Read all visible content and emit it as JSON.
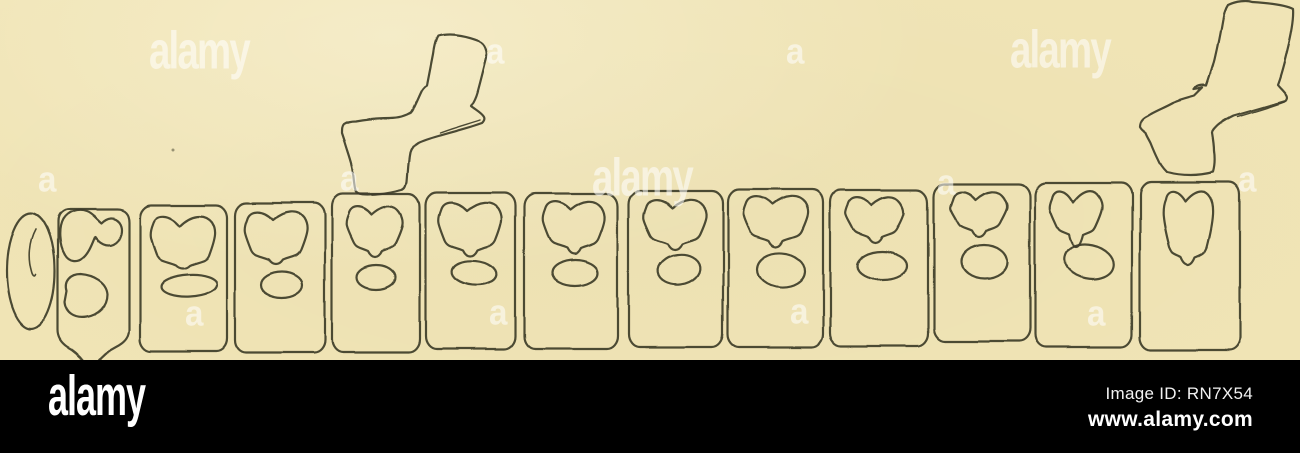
{
  "canvas": {
    "width": 1300,
    "height": 453,
    "paper_color": "#f1e5b6",
    "ink_color": "#3e3c29",
    "bar_color": "#000000",
    "watermark_color": "rgba(255,255,255,0.48)"
  },
  "footer": {
    "logo_text": "alamy",
    "image_id": "Image ID: RN7X54",
    "website": "www.alamy.com"
  },
  "watermarks": [
    {
      "text": "alamy",
      "kind": "wordmark",
      "x": 149,
      "y": 24
    },
    {
      "text": "a",
      "kind": "letter",
      "x": 486,
      "y": 33
    },
    {
      "text": "a",
      "kind": "letter",
      "x": 786,
      "y": 33
    },
    {
      "text": "alamy",
      "kind": "wordmark",
      "x": 1010,
      "y": 23
    },
    {
      "text": "a",
      "kind": "letter",
      "x": 38,
      "y": 161
    },
    {
      "text": "a",
      "kind": "letter",
      "x": 340,
      "y": 160
    },
    {
      "text": "alamy",
      "kind": "wordmark",
      "x": 592,
      "y": 151
    },
    {
      "text": "a",
      "kind": "letter",
      "x": 937,
      "y": 164
    },
    {
      "text": "a",
      "kind": "letter",
      "x": 1238,
      "y": 161
    },
    {
      "text": "a",
      "kind": "letter",
      "x": 185,
      "y": 295
    },
    {
      "text": "a",
      "kind": "letter",
      "x": 489,
      "y": 294
    },
    {
      "text": "a",
      "kind": "letter",
      "x": 790,
      "y": 293
    },
    {
      "text": "a",
      "kind": "letter",
      "x": 1087,
      "y": 295
    }
  ],
  "figure": {
    "description": "antique line drawing of a row of vertebral segments with two rib processes",
    "speck": {
      "cx": 173,
      "cy": 150,
      "r": 1.5
    },
    "lead_oval": {
      "cx": 31,
      "cy": 271,
      "rx": 24,
      "ry": 58,
      "slit": "M36,229 C29,242 28,258 32,272 C33,276 35,278 36,275"
    },
    "segment2": {
      "outline": "M70,209 C63,209 58,214 58,221 L58,330 C58,338 62,343 68,347 C74,350 80,356 84,361 C88,367 93,368 96,363 C101,356 108,350 116,346 C124,342 129,337 129,329 L129,222 C129,214 125,209 117,209 Z",
      "crown": "M65,255 C59,245 58,228 63,219 C68,211 78,208 86,211 C92,213 96,219 101,223 C107,217 114,216 119,222 C124,229 121,240 113,244 C106,247 99,243 95,237 C92,244 89,253 83,258 C77,263 69,262 65,255 Z",
      "blob": "M67,291 C64,281 71,274 81,274 C94,275 107,282 108,294 C108,306 99,315 87,317 C75,319 66,313 65,302 Z"
    },
    "segments": [
      {
        "rect": [
          140,
          205,
          87,
          146
        ],
        "crown": {
          "cx": 183,
          "top": 212,
          "w": 64,
          "h": 56,
          "stem": 4,
          "dip": 14
        },
        "oval": [
          189,
          286,
          28,
          11,
          -3
        ]
      },
      {
        "rect": [
          235,
          203,
          90,
          150
        ],
        "crown": {
          "cx": 276,
          "top": 208,
          "w": 62,
          "h": 54,
          "stem": 6,
          "dip": 12
        },
        "oval": [
          282,
          285,
          21,
          13,
          0
        ]
      },
      {
        "rect": [
          332,
          194,
          88,
          158
        ],
        "crown": {
          "cx": 375,
          "top": 203,
          "w": 56,
          "h": 50,
          "stem": 8,
          "dip": 12
        },
        "oval": [
          376,
          277,
          19,
          12,
          0
        ]
      },
      {
        "rect": [
          426,
          192,
          89,
          157
        ],
        "crown": {
          "cx": 470,
          "top": 198,
          "w": 62,
          "h": 54,
          "stem": 8,
          "dip": 12
        },
        "oval": [
          474,
          273,
          22,
          12,
          6
        ]
      },
      {
        "rect": [
          524,
          193,
          94,
          156
        ],
        "crown": {
          "cx": 574,
          "top": 197,
          "w": 62,
          "h": 53,
          "stem": 8,
          "dip": 12
        },
        "oval": [
          575,
          273,
          23,
          13,
          0
        ]
      },
      {
        "rect": [
          629,
          191,
          94,
          156
        ],
        "crown": {
          "cx": 675,
          "top": 196,
          "w": 62,
          "h": 50,
          "stem": 8,
          "dip": 12
        },
        "oval": [
          679,
          270,
          21,
          15,
          -8
        ]
      },
      {
        "rect": [
          728,
          190,
          95,
          157
        ],
        "crown": {
          "cx": 776,
          "top": 193,
          "w": 64,
          "h": 50,
          "stem": 8,
          "dip": 12
        },
        "oval": [
          781,
          270,
          24,
          17,
          4
        ]
      },
      {
        "rect": [
          830,
          190,
          98,
          156
        ],
        "crown": {
          "cx": 875,
          "top": 193,
          "w": 58,
          "h": 46,
          "stem": 8,
          "dip": 12
        },
        "oval": [
          882,
          266,
          25,
          14,
          0
        ]
      },
      {
        "rect": [
          934,
          184,
          96,
          157
        ],
        "crown": {
          "cx": 979,
          "top": 188,
          "w": 56,
          "h": 45,
          "stem": 8,
          "dip": 12
        },
        "oval": [
          984,
          262,
          23,
          17,
          0
        ]
      },
      {
        "rect": [
          1035,
          183,
          97,
          164
        ],
        "crown": {
          "cx": 1076,
          "top": 187,
          "w": 52,
          "h": 50,
          "stem": 16,
          "dip": 16
        },
        "oval": [
          1089,
          262,
          25,
          17,
          12
        ]
      },
      {
        "rect": [
          1140,
          182,
          100,
          168
        ],
        "crown": {
          "cx": 1188,
          "top": 187,
          "w": 50,
          "h": 72,
          "stem": 10,
          "dip": 14
        },
        "oval": null
      }
    ],
    "ribs": [
      {
        "path": "M438,37 C452,33 469,38 479,42 C484,44 487,51 486,58 C483,70 480,82 477,93 C475,100 473,103 471,106 C476,110 482,113 484,117 C485,119 484,121 482,123 C468,128 452,132 438,136 C431,138 424,140 418,143 C413,146 411,149 410,153 C408,163 408,172 407,182 C406,187 405,189 402,190 C391,193 379,195 368,195 C362,195 357,194 356,191 C354,182 354,172 352,165 C350,157 347,149 345,142 C344,139 343,136 342,133 C342,129 342,126 344,124 C347,122 352,121 356,121 C367,119 379,118 390,118 C398,118 406,116 412,112 C416,105 419,97 422,91 C424,88 425,87 427,86 C429,76 431,65 433,55 C434,48 436,40 438,37 Z",
        "flange": "M440,133 C453,128 468,124 480,120"
      },
      {
        "path": "M1228,5 C1236,1 1247,0 1252,2 C1268,3 1286,5 1293,9 C1294,21 1290,38 1287,50 C1284,62 1281,75 1277,85 C1280,89 1284,92 1286,96 C1287,98 1286,100 1285,101 C1268,106 1250,111 1233,116 C1227,119 1220,123 1217,126 C1214,129 1212,131 1212,133 C1213,139 1214,145 1214,151 C1215,158 1215,165 1213,172 C1205,174 1197,175 1190,175 C1182,175 1174,174 1167,172 C1163,168 1160,164 1158,159 C1155,153 1153,148 1151,143 C1149,139 1147,136 1146,133 C1143,131 1141,129 1140,127 C1140,123 1141,121 1143,119 C1145,117 1148,116 1151,114 C1158,110 1166,107 1173,103 C1180,100 1188,98 1195,96 C1198,93 1201,90 1203,88 C1200,89 1197,90 1194,90 C1197,86 1203,85 1207,86 C1210,77 1213,68 1215,60 C1218,47 1221,32 1223,20 C1224,13 1226,8 1228,5 Z",
        "flange": "M1237,117 C1253,112 1271,107 1284,102"
      }
    ]
  }
}
